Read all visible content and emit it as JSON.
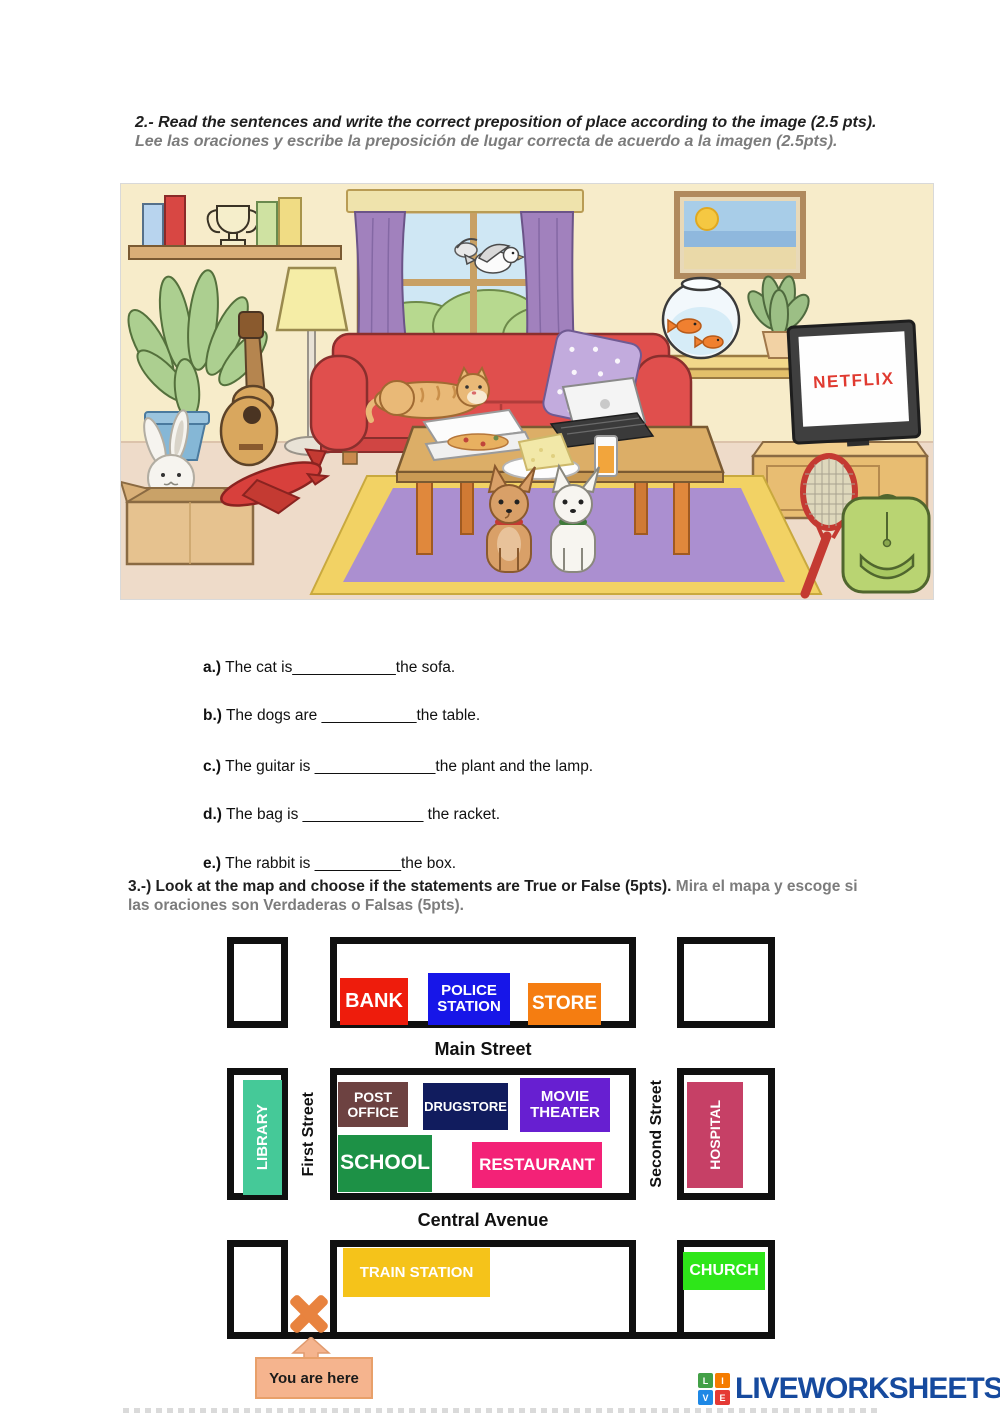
{
  "section2": {
    "heading_en": "2.- Read the sentences and write the correct preposition of place according to the image (2.5 pts). ",
    "heading_es": "Lee las oraciones y escribe la preposición de lugar correcta de acuerdo a la imagen (2.5pts).",
    "sentences": [
      {
        "letter": "a.)",
        "before": "The cat is",
        "blank": "____________",
        "after": "the sofa."
      },
      {
        "letter": "b.)",
        "before": "The dogs are ",
        "blank": "___________",
        "after": "the table."
      },
      {
        "letter": "c.)",
        "before": "The guitar is ",
        "blank": "______________",
        "after": "the plant and the lamp."
      },
      {
        "letter": "d.)",
        "before": "The bag is ",
        "blank": "______________",
        "after": " the racket."
      },
      {
        "letter": "e.)",
        "before": "The rabbit is ",
        "blank": "__________",
        "after": "the box."
      }
    ]
  },
  "scene": {
    "netflix_label": "NETFLIX",
    "objects": [
      "bookshelf",
      "books",
      "trophy",
      "window",
      "curtains",
      "birds",
      "bushes",
      "picture-frame",
      "plant",
      "floor-lamp",
      "guitar",
      "sofa",
      "cat",
      "polka-dot-pillow",
      "fishbowl",
      "goldfish",
      "side-table",
      "potted-plant",
      "tv",
      "tv-stand",
      "tennis-racket",
      "backpack",
      "rug",
      "coffee-table",
      "pizza-box",
      "sandwich-plate",
      "laptop",
      "juice-glass",
      "dogs",
      "cardboard-box",
      "rabbit",
      "toy-plane"
    ]
  },
  "section3": {
    "heading_en": "3.-) Look at the map and choose if the statements are True or False (5pts). ",
    "heading_es": "Mira el mapa y escoge si las oraciones son Verdaderas o Falsas (5pts)."
  },
  "map": {
    "streets": {
      "main": "Main Street",
      "central": "Central Avenue",
      "first": "First Street",
      "second": "Second Street"
    },
    "buildings": [
      {
        "label": "BANK",
        "color": "#ee1c0c"
      },
      {
        "label": "POLICE STATION",
        "color": "#1716e8"
      },
      {
        "label": "STORE",
        "color": "#f57d11"
      },
      {
        "label": "LIBRARY",
        "color": "#45c998"
      },
      {
        "label": "POST OFFICE",
        "color": "#6d4241"
      },
      {
        "label": "DRUGSTORE",
        "color": "#111c5e"
      },
      {
        "label": "MOVIE THEATER",
        "color": "#671fd1"
      },
      {
        "label": "SCHOOL",
        "color": "#1d9146"
      },
      {
        "label": "RESTAURANT",
        "color": "#f32277"
      },
      {
        "label": "HOSPITAL",
        "color": "#c64066"
      },
      {
        "label": "TRAIN STATION",
        "color": "#f5c31a"
      },
      {
        "label": "CHURCH",
        "color": "#2ee619"
      }
    ],
    "you_are_here": "You are here",
    "marker_color": "#e8833f",
    "label_bg": "#f5b48e"
  },
  "footer": {
    "logo_text": "LIVEWORKSHEETS",
    "logo_color": "#164a9e",
    "logo_squares": [
      {
        "letter": "L",
        "color": "#43a047"
      },
      {
        "letter": "I",
        "color": "#f57c00"
      },
      {
        "letter": "V",
        "color": "#1e88e5"
      },
      {
        "letter": "E",
        "color": "#e53935"
      }
    ]
  }
}
